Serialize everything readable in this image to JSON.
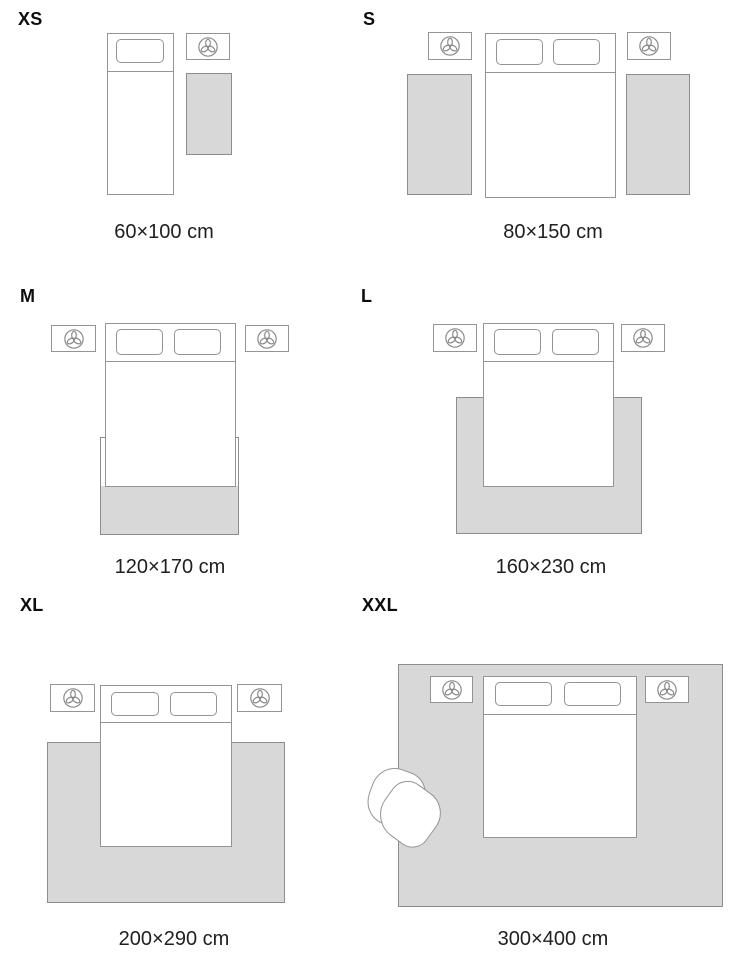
{
  "title": "Rug size guide",
  "unit": "cm",
  "colors": {
    "background": "#ffffff",
    "rug_fill": "#d8d8d8",
    "rug_outline": "#8d8d8d",
    "furniture_outline": "#949494",
    "text": "#0d0d0d"
  },
  "icons": {
    "nightstand": "plant-icon"
  },
  "panels": [
    {
      "size_label": "XS",
      "dimensions": "60×100 cm",
      "bed": "single-bed",
      "nightstands": 1,
      "rugs": 1
    },
    {
      "size_label": "S",
      "dimensions": "80×150 cm",
      "bed": "double-bed",
      "nightstands": 2,
      "rugs": 2
    },
    {
      "size_label": "M",
      "dimensions": "120×170 cm",
      "bed": "double-bed",
      "nightstands": 2,
      "rugs": 1
    },
    {
      "size_label": "L",
      "dimensions": "160×230 cm",
      "bed": "double-bed",
      "nightstands": 2,
      "rugs": 1
    },
    {
      "size_label": "XL",
      "dimensions": "200×290 cm",
      "bed": "double-bed",
      "nightstands": 2,
      "rugs": 1
    },
    {
      "size_label": "XXL",
      "dimensions": "300×400 cm",
      "bed": "double-bed",
      "nightstands": 2,
      "rugs": 1,
      "extra_furniture": "armchair"
    }
  ]
}
